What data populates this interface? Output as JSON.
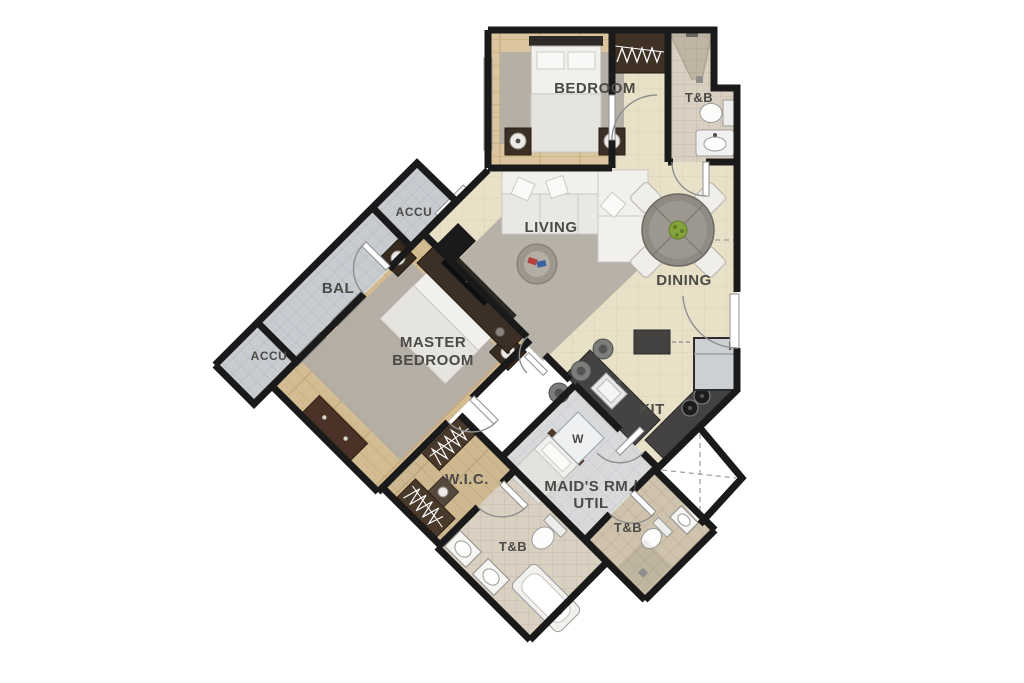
{
  "plan": {
    "rooms": {
      "bedroom": {
        "label": "BEDROOM"
      },
      "bath_top": {
        "label": "T&B"
      },
      "living": {
        "label": "LIVING"
      },
      "dining": {
        "label": "DINING"
      },
      "balcony": {
        "label": "BAL"
      },
      "accu_upper": {
        "label": "ACCU"
      },
      "accu_lower": {
        "label": "ACCU"
      },
      "master_bedroom": {
        "label_line1": "MASTER",
        "label_line2": "BEDROOM"
      },
      "walk_in_closet": {
        "label": "W.I.C."
      },
      "washer": {
        "label": "W"
      },
      "maids_room": {
        "label_line1": "MAID'S RM./",
        "label_line2": "UTIL"
      },
      "kitchen": {
        "label": "KIT"
      },
      "bath_master": {
        "label": "T&B"
      },
      "bath_common": {
        "label": "T&B"
      }
    },
    "colors": {
      "wall": "#1a1a1a",
      "floor_beige": "#e8e1c8",
      "floor_wood": "#dac59e",
      "floor_wood_master": "#d3bc92",
      "floor_wic": "#cdb88f",
      "tile_cool": "#c8ccd1",
      "tile_warm": "#d9d0c1",
      "tile_tan": "#cfc3ae",
      "floor_service": "#d8d9db",
      "rug": "#b5afa6",
      "counter_dark": "#434241",
      "furniture_wood": "#4a3226",
      "fixture_white": "#f2f1ee",
      "label_text": "#4b4a47",
      "plant_green": "#86a23c"
    }
  }
}
